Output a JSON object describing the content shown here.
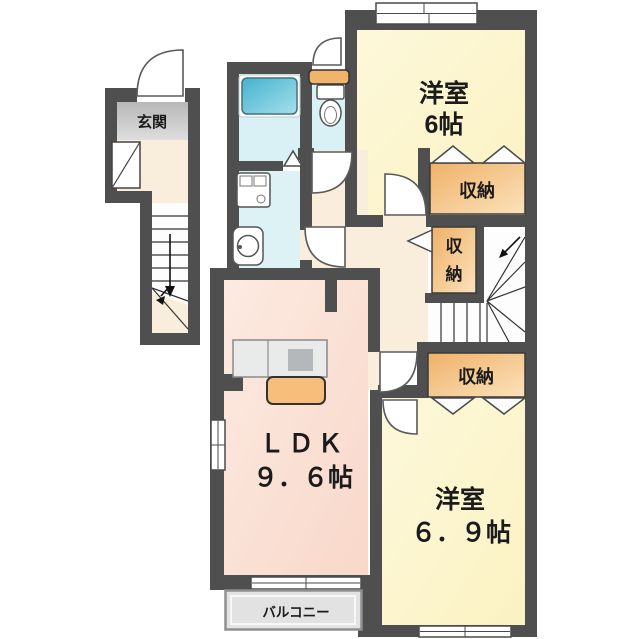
{
  "floorplan": {
    "entrance": {
      "label": "玄関"
    },
    "western_room_top": {
      "name": "洋室",
      "size": "6帖"
    },
    "storage_top": {
      "label": "収納"
    },
    "storage_mid": {
      "char_top": "収",
      "char_bottom": "納"
    },
    "storage_bottom": {
      "label": "収納"
    },
    "ldk": {
      "name": "ＬＤＫ",
      "size": "９．６帖"
    },
    "western_room_bottom": {
      "name": "洋室",
      "size": "６．９帖"
    },
    "balcony": {
      "label": "バルコニー"
    },
    "colors": {
      "wall": "#4f4f4f",
      "room_yellow": "#fcf6cf",
      "ldk_pink": "#fbe3d8",
      "hall_beige": "#f8eedb",
      "storage_orange_start": "#efb168",
      "storage_orange_end": "#fbe2bb",
      "water_blue": "#d9f0f4",
      "washroom_blue": "#dcf2f5",
      "bathtub_blue": "#4fb9d5",
      "entrance_gray": "#c6c6c6",
      "balcony_gray": "#e2e2e2",
      "kitchen_counter_orange": "#f6bd7b"
    }
  }
}
